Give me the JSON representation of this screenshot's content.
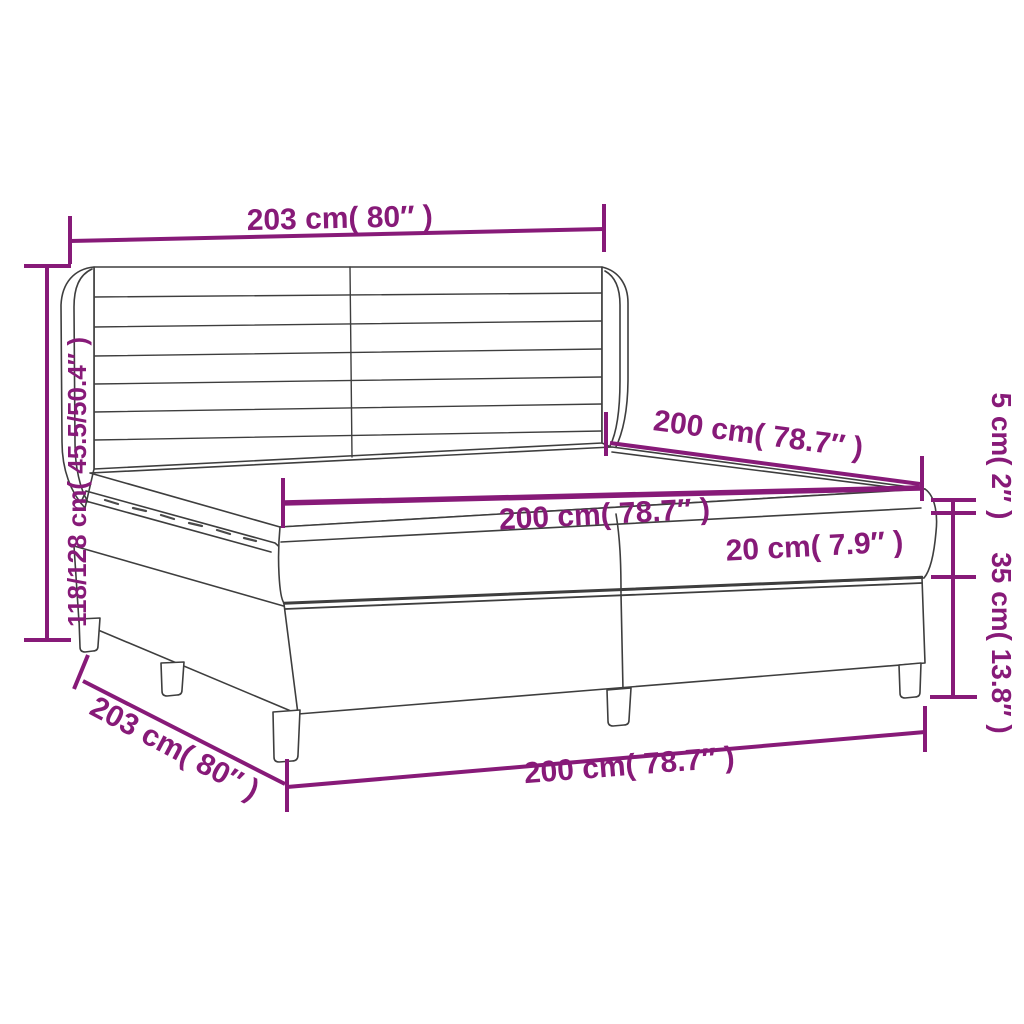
{
  "diagram": {
    "colors": {
      "dimension_accent": "#871a78",
      "artwork_line": "#3e3e3e",
      "background": "#ffffff"
    },
    "dims": {
      "headboard_width": "203 cm( 80″ )",
      "total_height": "118/128 cm( 45.5/50.4″ )",
      "bed_length_upper": "200 cm( 78.7″ )",
      "mattress_width": "200 cm( 78.7″ )",
      "mattress_height": "20 cm( 7.9″ )",
      "topper_height": "5 cm( 2″ )",
      "base_height": "35 cm( 13.8″ )",
      "base_width_diagonal": "203 cm( 80″ )",
      "bed_length_bottom": "200 cm( 78.7″ )"
    }
  }
}
